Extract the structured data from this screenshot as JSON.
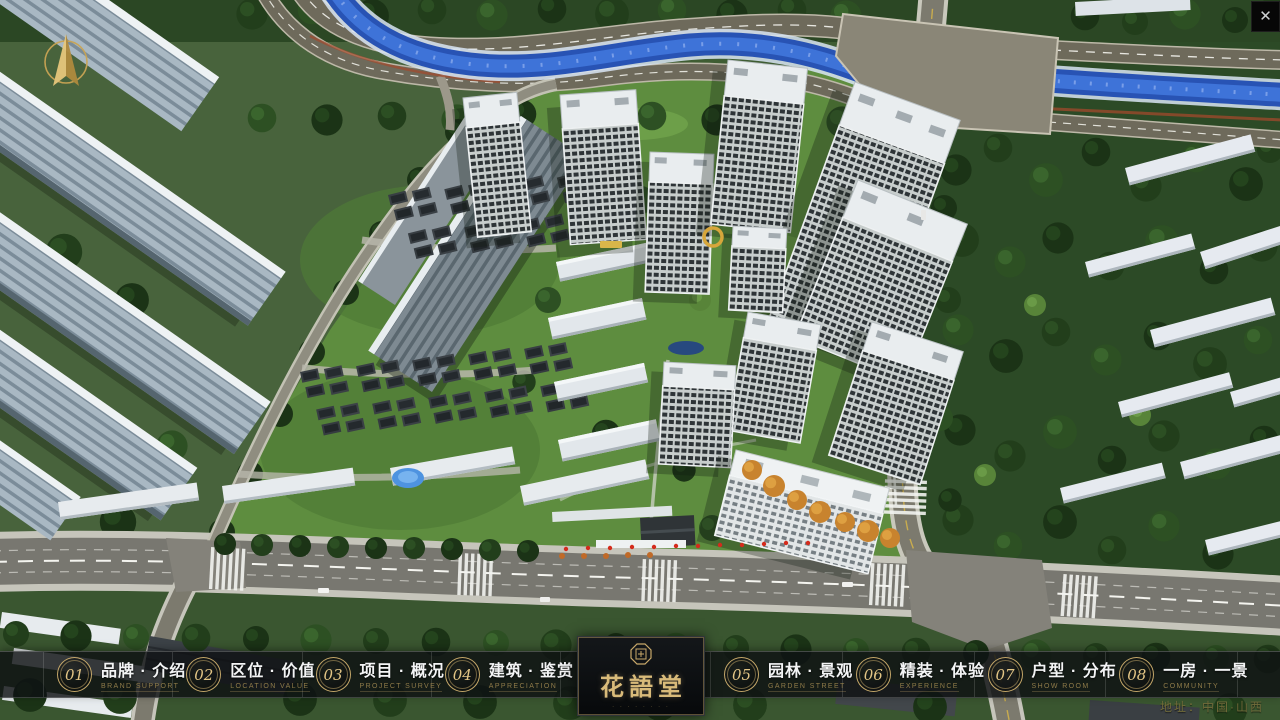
{
  "ui": {
    "close_glyph": "✕"
  },
  "nav": {
    "items": [
      {
        "num": "01",
        "title": "品牌 · 介绍",
        "subtitle": "BRAND SUPPORT"
      },
      {
        "num": "02",
        "title": "区位 · 价值",
        "subtitle": "LOCATION VALUE"
      },
      {
        "num": "03",
        "title": "项目 · 概况",
        "subtitle": "PROJECT SURVEY"
      },
      {
        "num": "04",
        "title": "建筑 · 鉴赏",
        "subtitle": "APPRECIATION"
      },
      {
        "num": "05",
        "title": "园林 · 景观",
        "subtitle": "GARDEN STREET"
      },
      {
        "num": "06",
        "title": "精装 · 体验",
        "subtitle": "EXPERIENCE"
      },
      {
        "num": "07",
        "title": "户型 · 分布",
        "subtitle": "SHOW ROOM"
      },
      {
        "num": "08",
        "title": "一房 · 一景",
        "subtitle": "COMMUNITY"
      }
    ]
  },
  "logo": {
    "name": "花語堂",
    "tagline": "· · · · · · · ·"
  },
  "footer": {
    "address": "地址：中国·山西"
  },
  "colors": {
    "gold": "#c8a86a",
    "gold_dim": "#8f7b49",
    "gold_bright": "#d9bb7a",
    "bar_bg": "rgba(13,16,18,0.82)",
    "red": "#d42b1c",
    "river_blue": "#2a57bd"
  }
}
